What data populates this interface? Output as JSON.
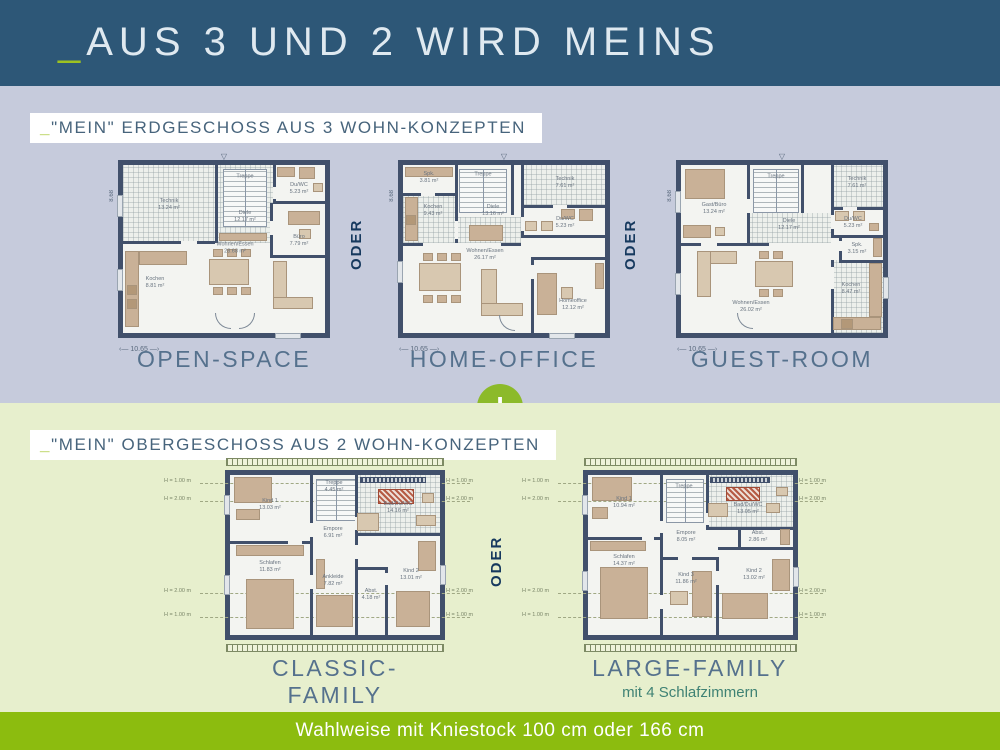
{
  "colors": {
    "header_bg": "#2d5777",
    "eg_bg": "#c6cbdc",
    "og_bg": "#e7efcd",
    "accent_green": "#9dc220",
    "footer_green": "#8cbc0f",
    "plus_green": "#8cba2a",
    "wall": "#41506b"
  },
  "header": {
    "accent": "_",
    "title": "AUS 3 UND 2 WIRD MEINS"
  },
  "plus": "+",
  "eg": {
    "label_accent": "_",
    "label": "\"MEIN\" ERDGESCHOSS AUS 3 WOHN-KONZEPTEN",
    "oder": "ODER",
    "roof_marker": "▽",
    "width_dim": "10.65",
    "depth_dim": "8.68",
    "plans": {
      "open_space": {
        "name": "OPEN-SPACE",
        "rooms": {
          "technik": {
            "name": "Technik",
            "area": "13.24 m²"
          },
          "treppe": {
            "name": "Treppe"
          },
          "diele": {
            "name": "Diele",
            "area": "12.17 m²"
          },
          "du_wc": {
            "name": "Du/WC",
            "area": "5.23 m²"
          },
          "buero": {
            "name": "Büro",
            "area": "7.79 m²"
          },
          "kochen": {
            "name": "Kochen",
            "area": "8.81 m²"
          },
          "wohnen": {
            "name": "Wohnen/Essen",
            "area": "28.68 m²"
          }
        }
      },
      "home_office": {
        "name": "HOME-OFFICE",
        "rooms": {
          "spk": {
            "name": "Spk.",
            "area": "3.81 m²"
          },
          "kochen": {
            "name": "Kochen",
            "area": "9.43 m²"
          },
          "treppe": {
            "name": "Treppe"
          },
          "technik": {
            "name": "Technik",
            "area": "7.61 m²"
          },
          "diele": {
            "name": "Diele",
            "area": "13.16 m²"
          },
          "du_wc": {
            "name": "Du/WC",
            "area": "5.23 m²"
          },
          "homeoffice": {
            "name": "Homeoffice",
            "area": "12.12 m²"
          },
          "wohnen": {
            "name": "Wohnen/Essen",
            "area": "26.17 m²"
          }
        }
      },
      "guest_room": {
        "name": "GUEST-ROOM",
        "rooms": {
          "gast": {
            "name": "Gast/Büro",
            "area": "13.24 m²"
          },
          "treppe": {
            "name": "Treppe"
          },
          "technik": {
            "name": "Technik",
            "area": "7.61 m²"
          },
          "diele": {
            "name": "Diele",
            "area": "12.17 m²"
          },
          "du_wc": {
            "name": "Du/WC",
            "area": "5.23 m²"
          },
          "spk": {
            "name": "Spk.",
            "area": "3.15 m²"
          },
          "kochen": {
            "name": "Kochen",
            "area": "8.47 m²"
          },
          "wohnen": {
            "name": "Wohnen/Essen",
            "area": "26.02 m²"
          }
        }
      }
    }
  },
  "og": {
    "label_accent": "_",
    "label": "\"MEIN\" OBERGESCHOSS AUS 2 WOHN-KONZEPTEN",
    "oder": "ODER",
    "height_marks": {
      "h1": "H = 1.00 m",
      "h2": "H = 2.00 m"
    },
    "plans": {
      "classic_family": {
        "name": "CLASSIC-FAMILY",
        "rooms": {
          "kind1": {
            "name": "Kind 1",
            "area": "13.03 m²"
          },
          "treppe": {
            "name": "Treppe",
            "area": "4.45 m²"
          },
          "empore": {
            "name": "Empore",
            "area": "6.91 m²"
          },
          "bad": {
            "name": "Bad/Du/WC",
            "area": "14.16 m²"
          },
          "schlafen": {
            "name": "Schlafen",
            "area": "11.83 m²"
          },
          "ankleide": {
            "name": "Ankleide",
            "area": "7.82 m²"
          },
          "abst": {
            "name": "Abst.",
            "area": "4.18 m²"
          },
          "kind2": {
            "name": "Kind 2",
            "area": "13.01 m²"
          }
        }
      },
      "large_family": {
        "name": "LARGE-FAMILY",
        "subtitle": "mit 4 Schlafzimmern",
        "rooms": {
          "kind1": {
            "name": "Kind 1",
            "area": "10.94 m²"
          },
          "treppe": {
            "name": "Treppe"
          },
          "empore": {
            "name": "Empore",
            "area": "8.05 m²"
          },
          "bad": {
            "name": "Bad/Du/WC",
            "area": "13.05 m²"
          },
          "abst": {
            "name": "Abst.",
            "area": "2.86 m²"
          },
          "schlafen": {
            "name": "Schlafen",
            "area": "14.37 m²"
          },
          "kind3": {
            "name": "Kind 3",
            "area": "11.86 m²"
          },
          "kind2": {
            "name": "Kind 2",
            "area": "13.02 m²"
          }
        }
      }
    }
  },
  "footer": {
    "text": "Wahlweise mit Kniestock 100 cm oder 166 cm"
  }
}
